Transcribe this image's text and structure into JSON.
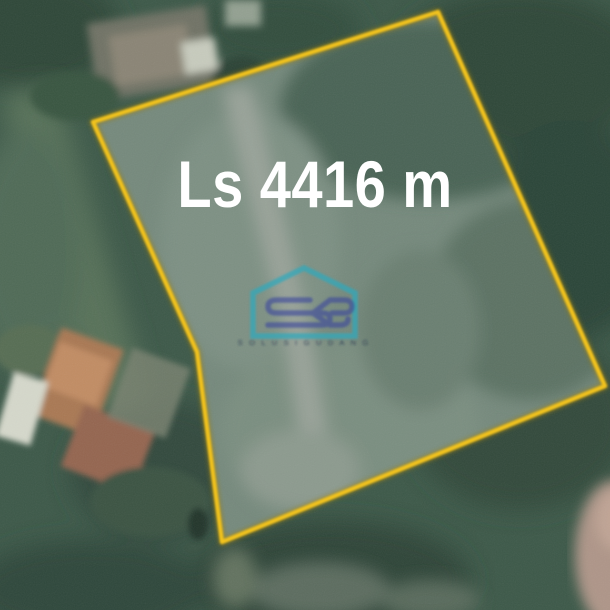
{
  "image": {
    "kind": "satellite-land-plot-listing"
  },
  "label": {
    "text": "Ls 4416 m",
    "color": "#ffffff"
  },
  "plot": {
    "boundary_color": "#f2c31e",
    "boundary_underlay_color": "#9a7f12",
    "vertices": [
      [
        93,
        122
      ],
      [
        438,
        12
      ],
      [
        605,
        386
      ],
      [
        222,
        542
      ],
      [
        197,
        352
      ]
    ]
  },
  "watermark": {
    "monogram": "SG",
    "wordmark": "S O L U S I   G U D A N G",
    "house_color": "#2fa9bc",
    "monogram_color": "#3d4a9c",
    "wordmark_color": "#22324f"
  }
}
